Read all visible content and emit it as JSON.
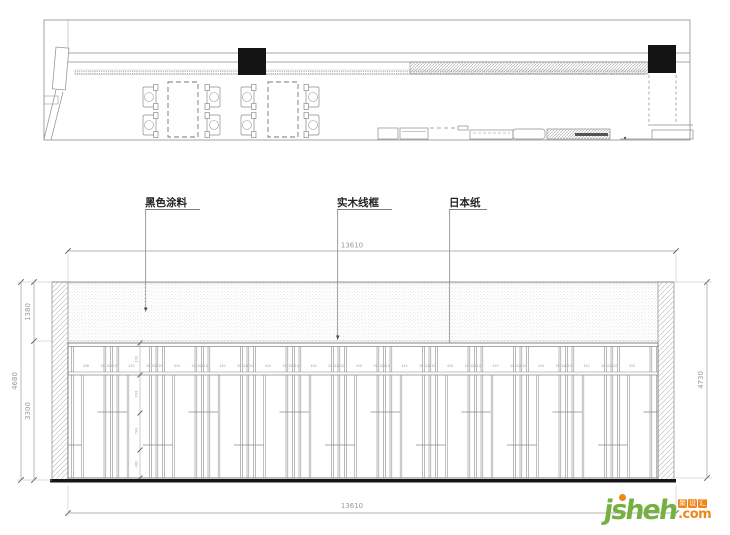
{
  "drawing": {
    "callouts": [
      {
        "text": "黑色涂料"
      },
      {
        "text": "实木线框"
      },
      {
        "text": "日本纸"
      }
    ],
    "dims": {
      "top_width": "13610",
      "bottom_width": "13610",
      "left_total": "4680",
      "left_upper": "1380",
      "left_lower": "3300",
      "right_total": "4730"
    },
    "elevation": {
      "small_dims": [
        "436",
        "20102010",
        "410",
        "20102010",
        "410",
        "20102010",
        "410",
        "20102010",
        "410",
        "20102010",
        "410",
        "20102010",
        "410",
        "20102010",
        "410",
        "20102010",
        "410",
        "20102010",
        "410",
        "20102010",
        "410",
        "20102010",
        "410",
        "20102010",
        "410"
      ],
      "chain_dims": [
        "110",
        "743",
        "743",
        "400"
      ]
    }
  },
  "logo": {
    "brand": "jsheh",
    "tld": ".com",
    "badge_chars": [
      "聚",
      "设",
      "汇"
    ]
  },
  "colors": {
    "line": "#8c8c8c",
    "dark_line": "#555555",
    "black_fill": "#141414",
    "dim_text": "#9a9a9a",
    "logo_green": "#76b043",
    "logo_orange": "#f08519"
  }
}
